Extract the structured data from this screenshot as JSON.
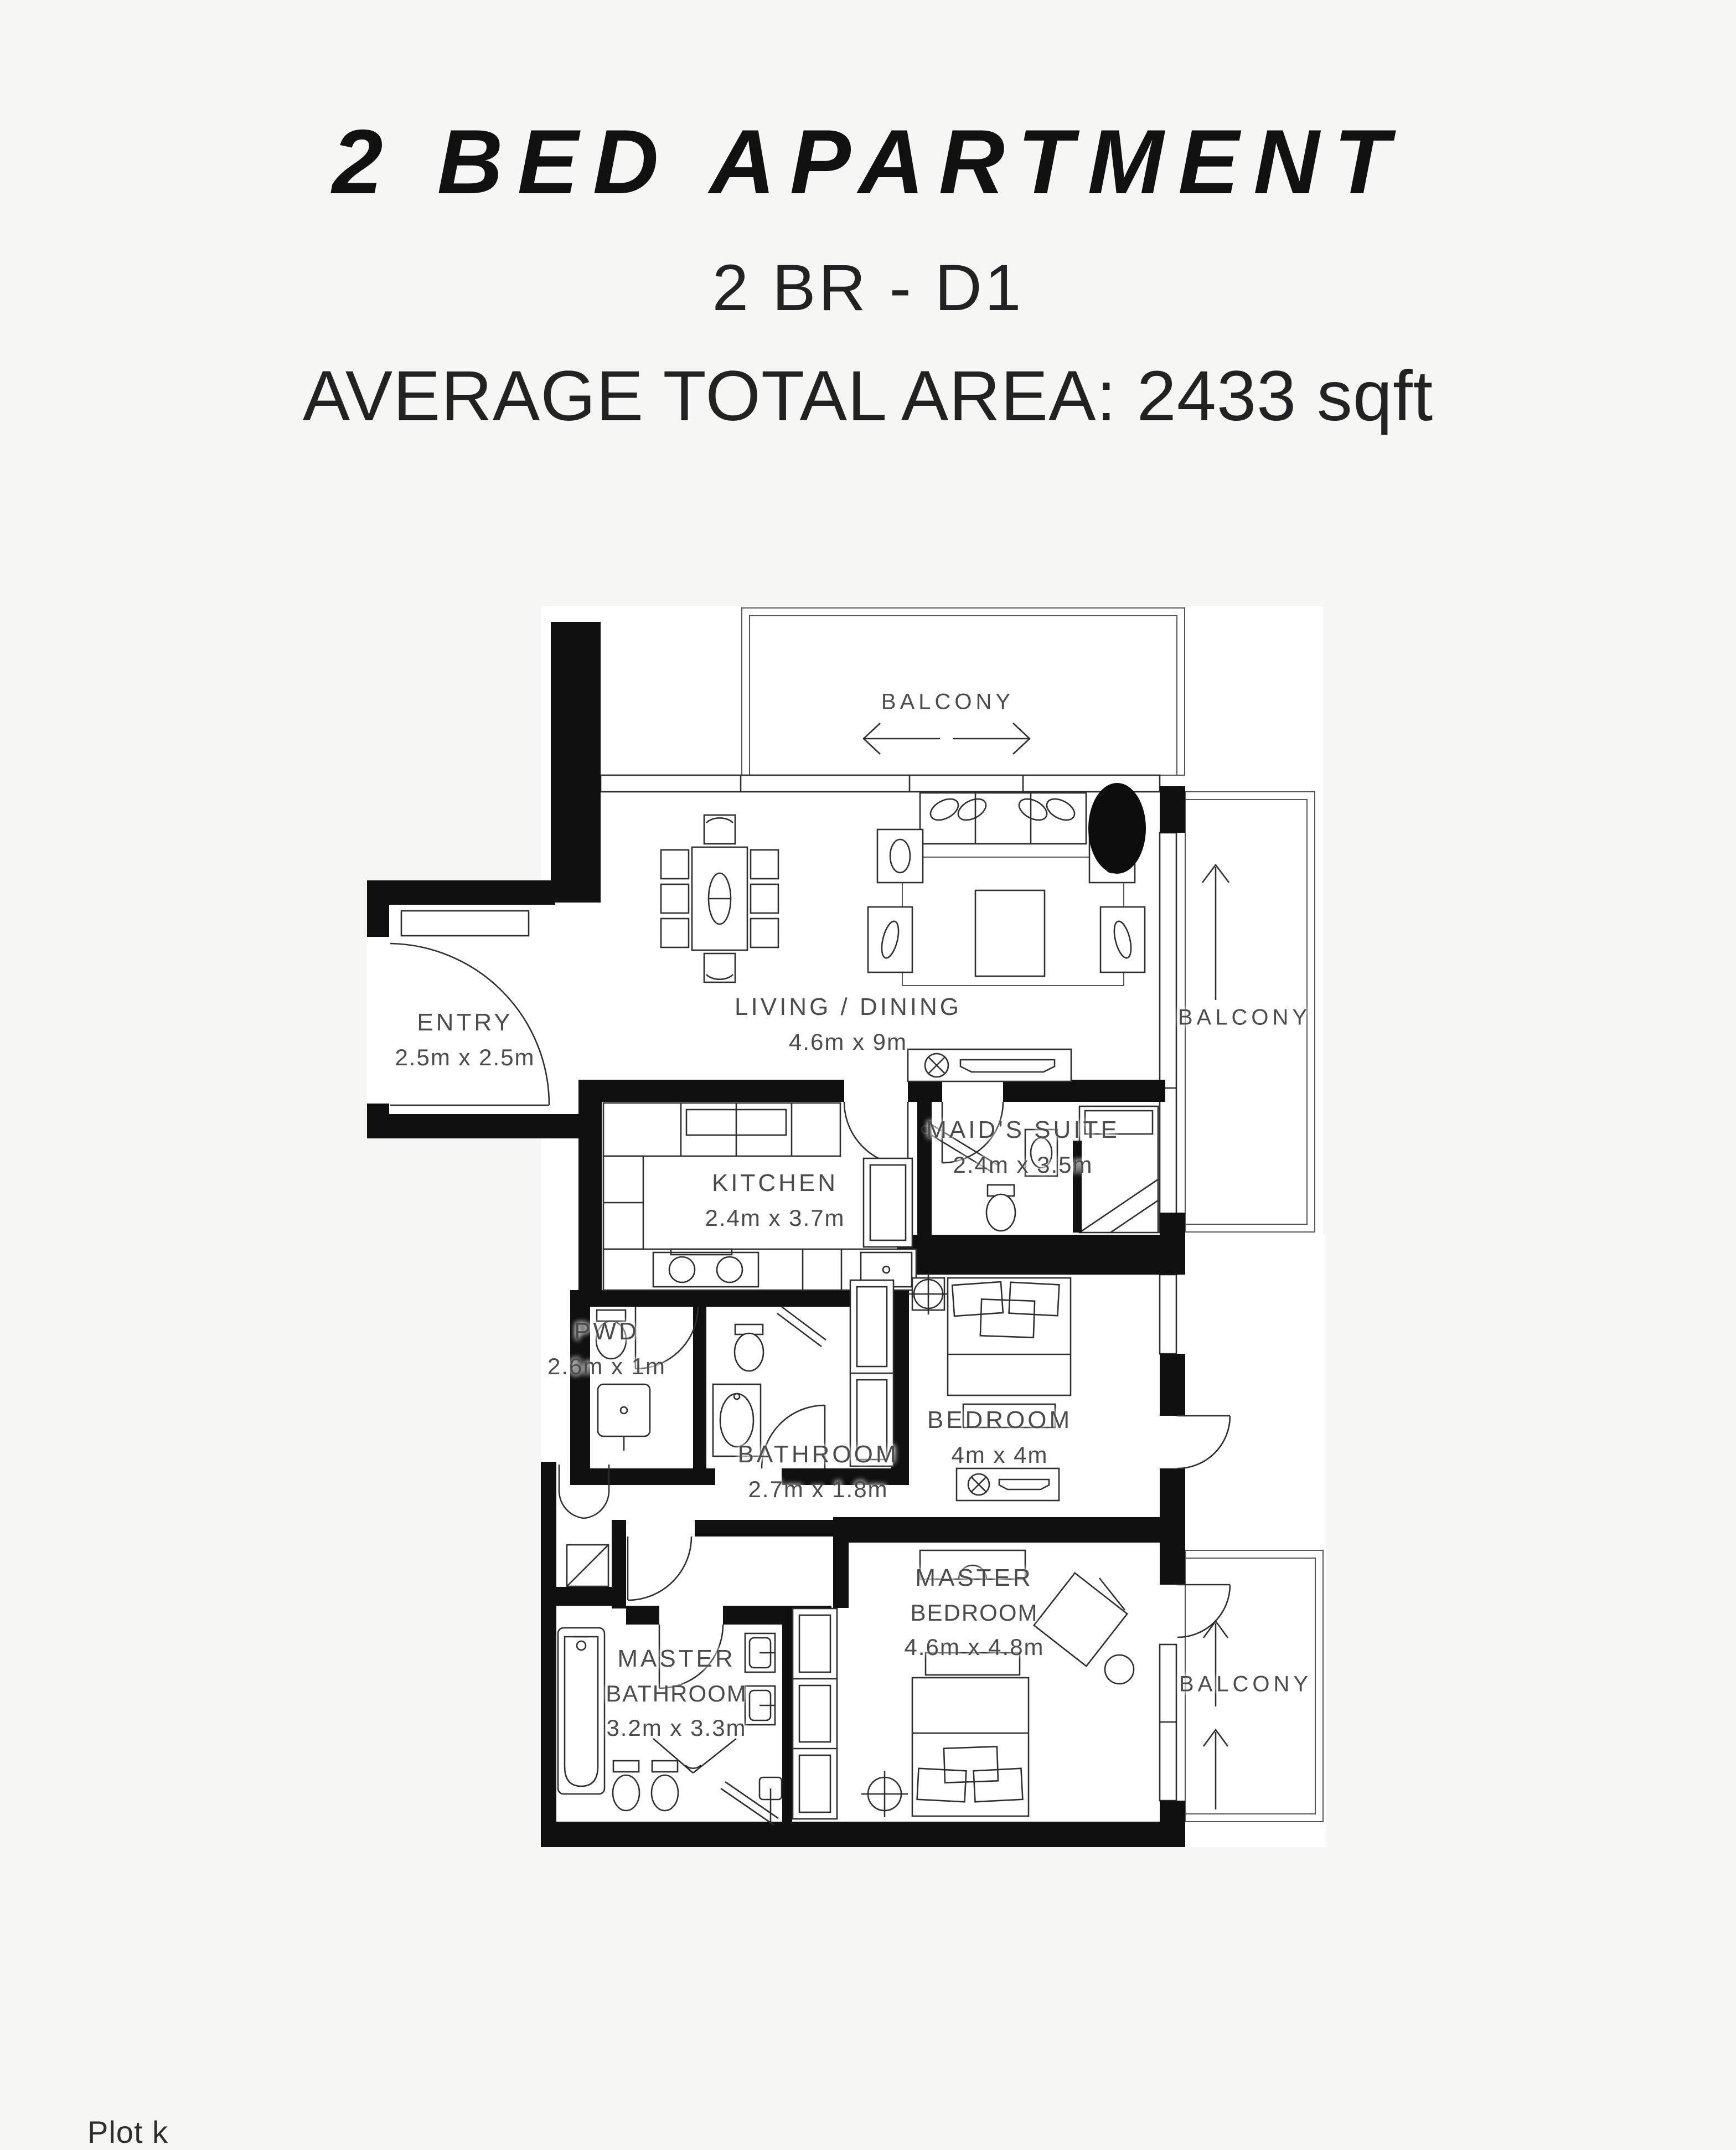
{
  "header": {
    "title": "2 BED APARTMENT",
    "subtitle": "2 BR - D1",
    "area_line": "AVERAGE TOTAL AREA: 2433 sqft"
  },
  "floorplan": {
    "labels": {
      "balcony_top": {
        "l1": "BALCONY"
      },
      "entry": {
        "l1": "ENTRY",
        "l2": "2.5m x 2.5m"
      },
      "living": {
        "l1": "LIVING / DINING",
        "l2": "4.6m x 9m"
      },
      "balcony_right": {
        "l1": "BALCONY"
      },
      "kitchen": {
        "l1": "KITCHEN",
        "l2": "2.4m x 3.7m"
      },
      "maids_suite": {
        "l1": "MAID'S SUITE",
        "l2": "2.4m x 3.5m"
      },
      "pwd": {
        "l1": "PWD",
        "l2": "2.6m x 1m"
      },
      "bathroom": {
        "l1": "BATHROOM",
        "l2": "2.7m x 1.8m"
      },
      "bedroom": {
        "l1": "BEDROOM",
        "l2": "4m x 4m"
      },
      "master_bedroom": {
        "l1": "MASTER",
        "l2": "BEDROOM",
        "l3": "4.6m x 4.8m"
      },
      "master_bathroom": {
        "l1": "MASTER",
        "l2": "BATHROOM",
        "l3": "3.2m x 3.3m"
      },
      "balcony_bottom": {
        "l1": "BALCONY"
      }
    },
    "partial_bottom_text": "Plot k",
    "colors": {
      "wall": "#101010",
      "line": "#2e2e2e",
      "label": "#4b4b4b",
      "paper": "#f6f6f4",
      "room_fill": "#ffffff"
    }
  }
}
